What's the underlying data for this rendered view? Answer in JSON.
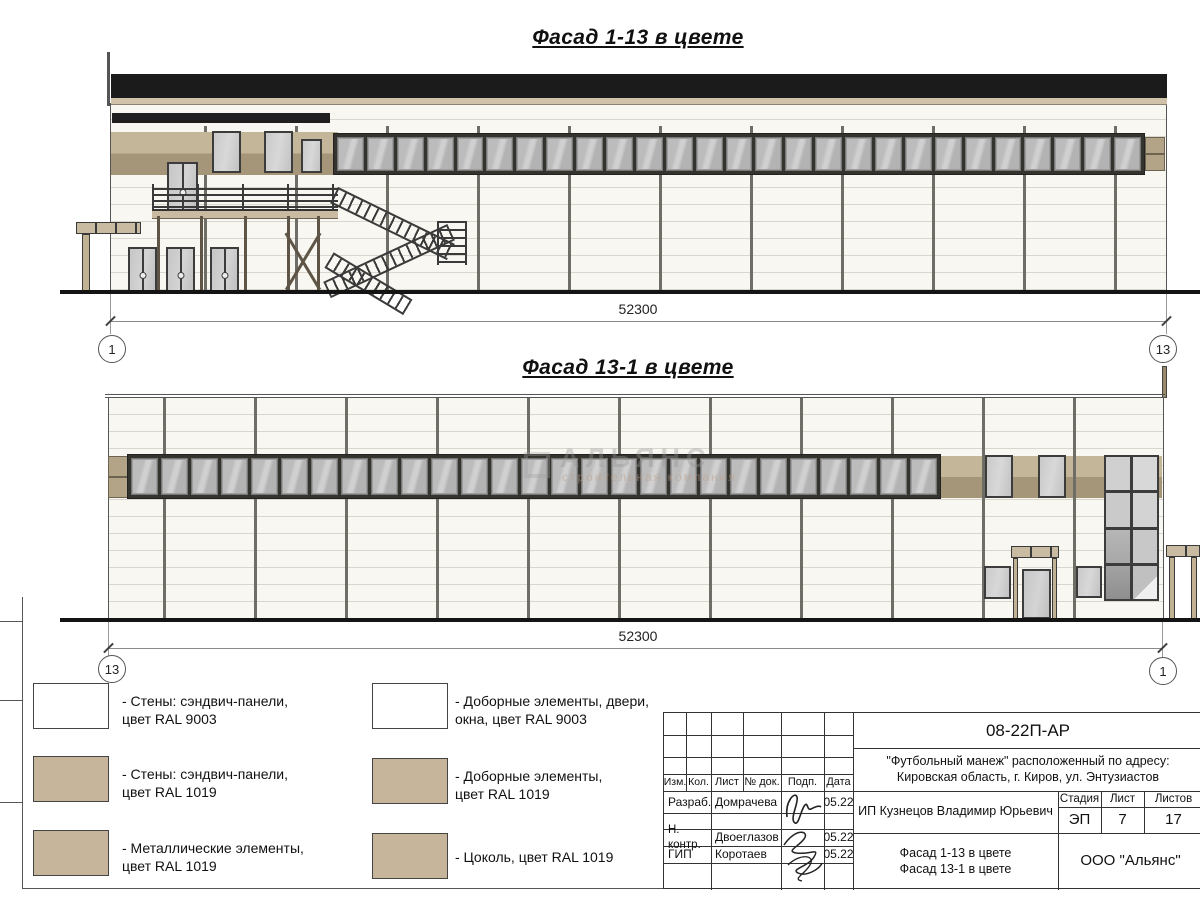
{
  "facade1": {
    "title": "Фасад 1-13 в цвете",
    "dim": "52300",
    "axis_left": "1",
    "axis_right": "13"
  },
  "facade2": {
    "title": "Фасад 13-1 в цвете",
    "dim": "52300",
    "axis_left": "13",
    "axis_right": "1"
  },
  "watermark": {
    "brand": "АЛЬЯНС",
    "tagline": "строительная компания"
  },
  "legend": {
    "items": [
      {
        "color": "#ffffff",
        "label": "- Стены: сэндвич-панели,\nцвет RAL 9003"
      },
      {
        "color": "#ffffff",
        "label": "- Доборные элементы, двери,\nокна, цвет RAL 9003"
      },
      {
        "color": "#c6b59a",
        "label": "- Стены: сэндвич-панели,\nцвет RAL 1019"
      },
      {
        "color": "#c6b59a",
        "label": "- Доборные элементы,\nцвет RAL 1019"
      },
      {
        "color": "#c6b59a",
        "label": "- Металлические элементы,\nцвет RAL 1019"
      },
      {
        "color": "#c6b59a",
        "label": "- Цоколь, цвет RAL 1019"
      }
    ]
  },
  "titleblock": {
    "doc": "08-22П-АР",
    "address1": "\"Футбольный манеж\" расположенный по адресу:",
    "address2": "Кировская область, г. Киров, ул. Энтузиастов",
    "h_izm": "Изм.",
    "h_kol": "Кол.",
    "h_list": "Лист",
    "h_ndok": "№ док.",
    "h_podp": "Подп.",
    "h_data": "Дата",
    "r1_role": "Разраб.",
    "r1_name": "Домрачева",
    "r1_date": "05.22",
    "r2_role": "Н. контр.",
    "r2_name": "Двоеглазов",
    "r2_date": "05.22",
    "r3_role": "ГИП",
    "r3_name": "Коротаев",
    "r3_date": "05.22",
    "client": "ИП Кузнецов Владимир Юрьевич",
    "h_stage": "Стадия",
    "h_sheet": "Лист",
    "h_sheets": "Листов",
    "stage": "ЭП",
    "sheet_no": "7",
    "sheets_total": "17",
    "title1": "Фасад 1-13 в цвете",
    "title2": "Фасад 13-1 в цвете",
    "company": "ООО \"Альянс\""
  },
  "colors": {
    "tan": "#c6b59a",
    "tan_dark": "#a5967a",
    "roof": "#1b1b1b",
    "glass": "#c9c9c9",
    "frame": "#3c3c3c"
  }
}
